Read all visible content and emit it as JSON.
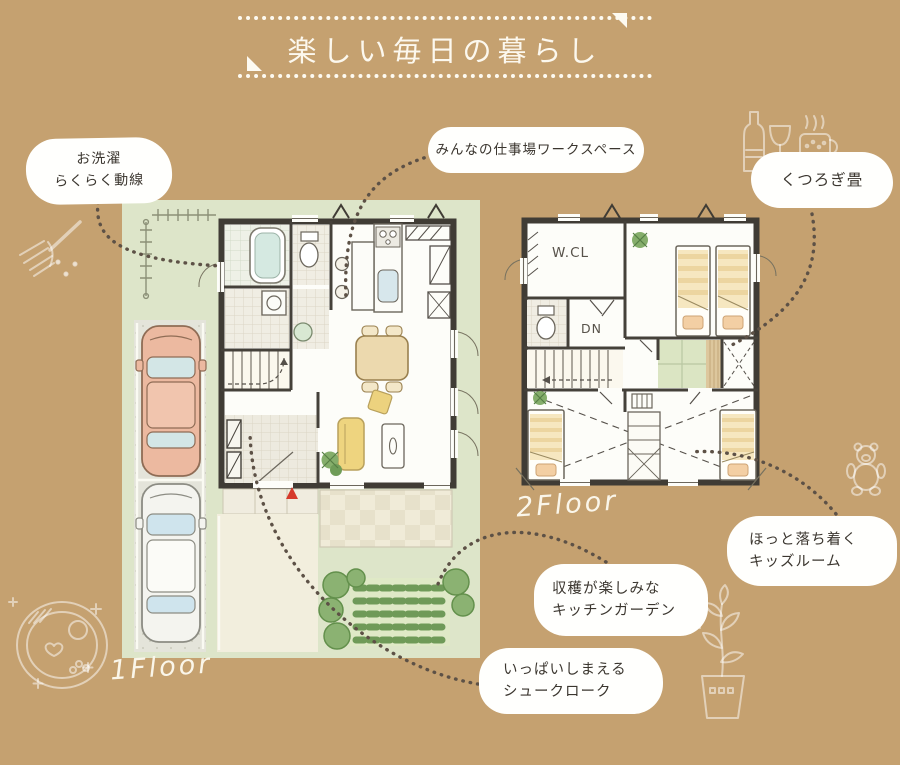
{
  "page": {
    "background": "#c5a170"
  },
  "header": {
    "title": "楽しい毎日の暮らし"
  },
  "floor1": {
    "label": "1Floor"
  },
  "floor2": {
    "label": "2Floor",
    "closet_label": "W.CL",
    "stairs_label": "DN"
  },
  "callouts": {
    "laundry": {
      "line1": "お洗濯",
      "line2": "らくらく動線"
    },
    "workspace": {
      "line1": "みんなの仕事場ワークスペース"
    },
    "tatami": {
      "line1": "くつろぎ畳"
    },
    "kids": {
      "line1": "ほっと落ち着く",
      "line2": "キッズルーム"
    },
    "garden": {
      "line1": "収穫が楽しみな",
      "line2": "キッチンガーデン"
    },
    "shoe": {
      "line1": "いっぱいしまえる",
      "line2": "シュークローク"
    }
  },
  "doodles": [
    "fork-icon",
    "breakfast-plate-icon",
    "wine-bottle-icon",
    "wine-glass-icon",
    "coffee-mug-icon",
    "teddy-bear-icon",
    "potted-plant-icon"
  ],
  "colors": {
    "background": "#c5a170",
    "bubble": "#ffffff",
    "ink": "#3b362f",
    "title_text": "#fcf8ee",
    "yard_green": "#dde5c9",
    "wall": "#403c35",
    "accent_red": "#d63a2c",
    "tatami_green": "#dbe5c3",
    "bed_stripe": "#ecd5a0",
    "car_salmon": "#ecb9a0",
    "garden_green": "#85ae6b",
    "connector_dots": "#5d5146"
  }
}
